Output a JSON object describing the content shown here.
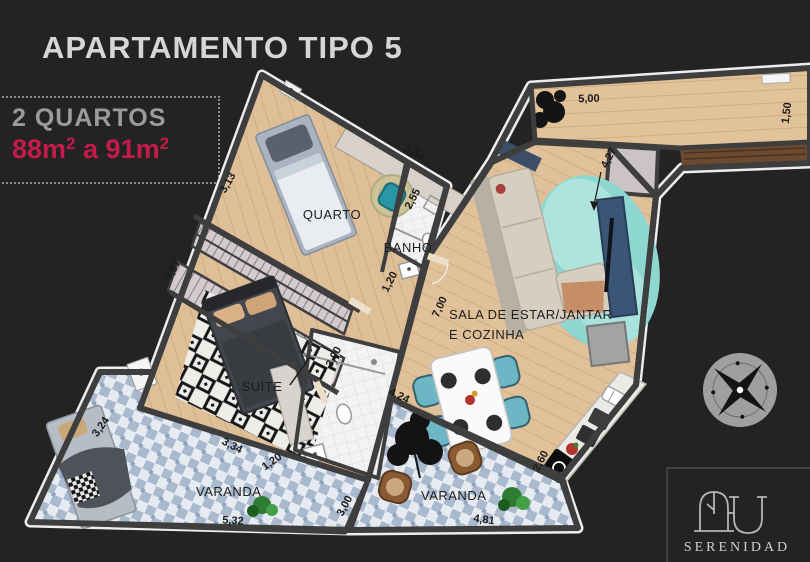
{
  "header": {
    "title": "APARTAMENTO TIPO 5"
  },
  "info_box": {
    "bedrooms": "2 QUARTOS",
    "area": {
      "b1": "88m",
      "s1": "2",
      "b2": " a 91m",
      "s2": "2"
    },
    "area_color": "#c51a4c"
  },
  "floorplan": {
    "rooms": {
      "quarto": {
        "label": "QUARTO",
        "dims": [
          "3,13",
          "3,34"
        ]
      },
      "banho": {
        "label": "BANHO",
        "dims": [
          "2,55",
          "1,20"
        ]
      },
      "suite": {
        "label": "SUÍTE",
        "dims": [
          "3,57",
          "3,34",
          "1,20",
          "3,00"
        ]
      },
      "sala": {
        "label_line1": "SALA DE ESTAR/JANTAR",
        "label_line2": "E COZINHA",
        "dims": [
          "7,00",
          "4,27",
          "4,24"
        ]
      },
      "terraco": {
        "dims": [
          "5,00",
          "1,50"
        ]
      },
      "varanda_left": {
        "label": "VARANDA",
        "dims": [
          "3,24",
          "5,32"
        ]
      },
      "varanda_right": {
        "label": "VARANDA",
        "dims": [
          "3,00",
          "4,81",
          "2,60"
        ]
      }
    },
    "colors": {
      "background": "#232323",
      "wall": "#3e3e3e",
      "wood_floor": "#debf97",
      "balcony_tile": "#cfd9e5",
      "accent_area": "#c51a4c",
      "title_text": "#d6d6d6"
    }
  },
  "compass": {
    "name": "compass-rose"
  },
  "brand": {
    "name": "SERENIDAD"
  }
}
